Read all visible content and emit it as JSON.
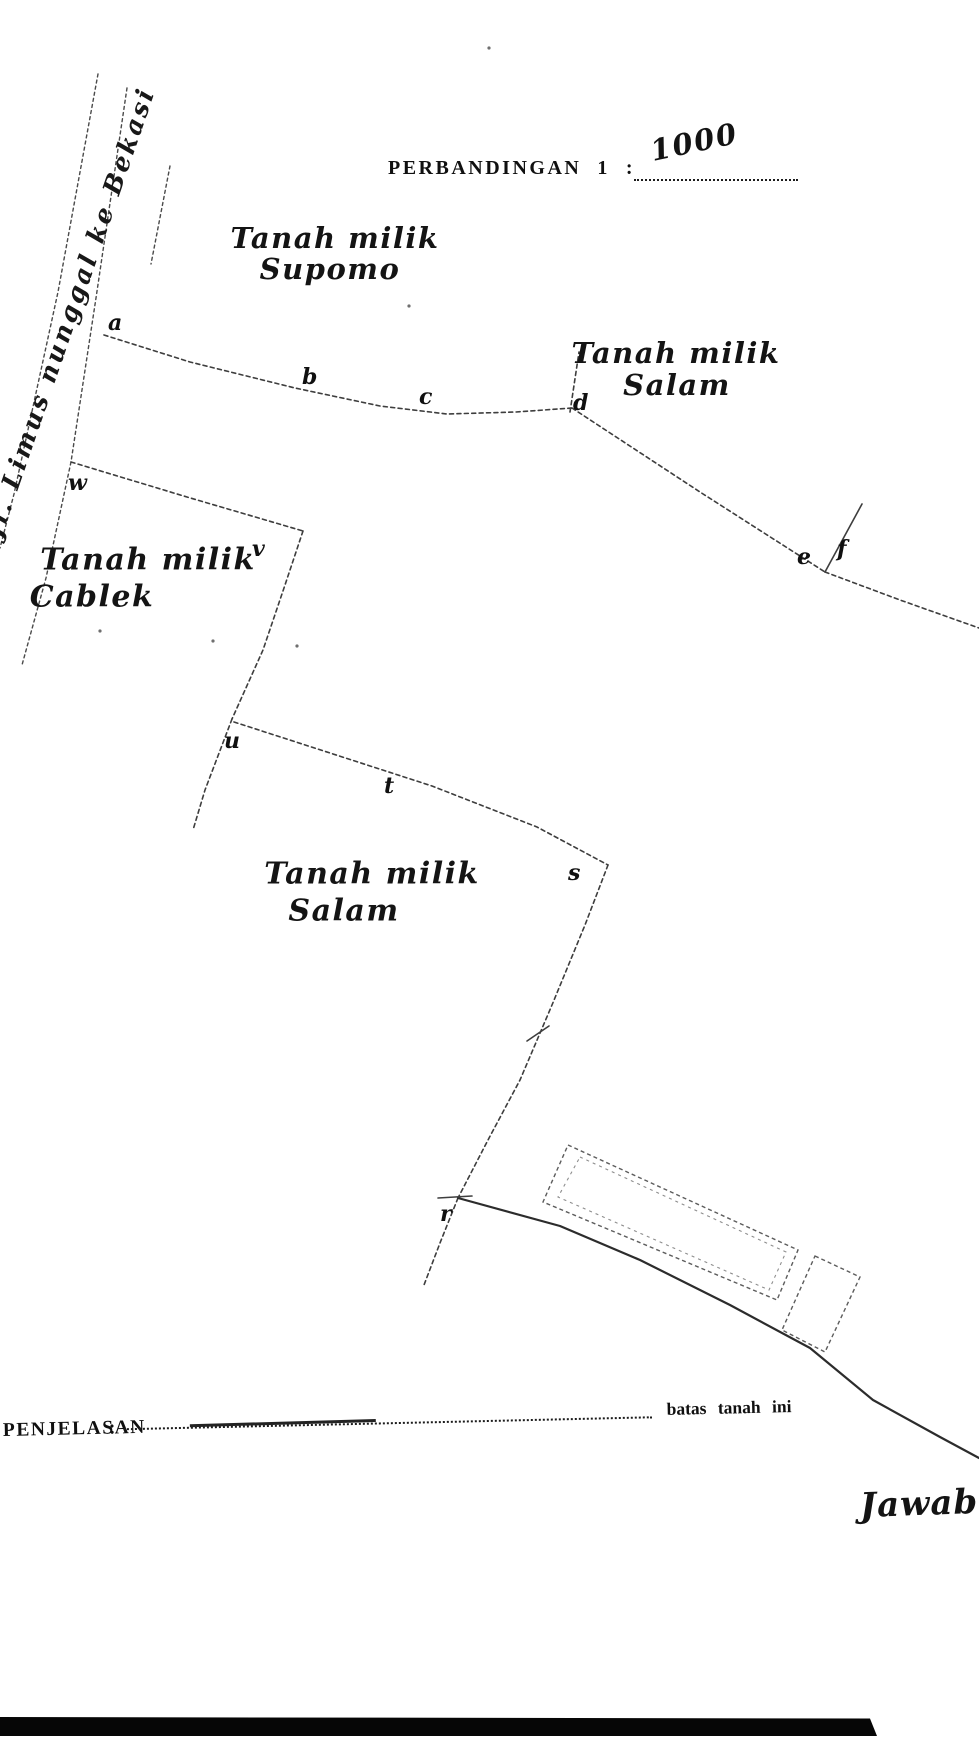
{
  "colors": {
    "paper": "#ffffff",
    "ink": "#1d1d1d",
    "line": "#3e3e3e",
    "scan_bar": "#060606"
  },
  "header": {
    "scale_label": "PERBANDINGAN",
    "scale_number": "1",
    "scale_colon": ":",
    "scale_value_handwritten": "1000"
  },
  "road": {
    "label": "Jl. Limus nunggal ke Bekasi"
  },
  "parcels": [
    {
      "id": "supomo",
      "line1": "Tanah milik",
      "line2": "Supomo",
      "x1": 335,
      "y1": 238,
      "x2": 330,
      "y2": 269,
      "size": 29,
      "rot": -2
    },
    {
      "id": "salam-top",
      "line1": "Tanah milik",
      "line2": "Salam",
      "x1": 676,
      "y1": 353,
      "x2": 677,
      "y2": 385,
      "size": 29,
      "rot": -2
    },
    {
      "id": "cablek",
      "line1": "Tanah milik",
      "line2": "Cablek",
      "x1": 148,
      "y1": 560,
      "x2": 92,
      "y2": 597,
      "size": 30,
      "rot": -4
    },
    {
      "id": "salam-bottom",
      "line1": "Tanah milik",
      "line2": "Salam",
      "x1": 372,
      "y1": 874,
      "x2": 344,
      "y2": 911,
      "size": 30,
      "rot": -4
    }
  ],
  "map": {
    "survey_points": [
      {
        "label": "a",
        "x": 108,
        "y": 312
      },
      {
        "label": "b",
        "x": 302,
        "y": 366
      },
      {
        "label": "c",
        "x": 419,
        "y": 386
      },
      {
        "label": "d",
        "x": 573,
        "y": 392
      },
      {
        "label": "e",
        "x": 797,
        "y": 546
      },
      {
        "label": "f",
        "x": 837,
        "y": 538
      },
      {
        "label": "w",
        "x": 68,
        "y": 472
      },
      {
        "label": "v",
        "x": 252,
        "y": 538
      },
      {
        "label": "u",
        "x": 224,
        "y": 730
      },
      {
        "label": "t",
        "x": 384,
        "y": 775
      },
      {
        "label": "s",
        "x": 568,
        "y": 862
      },
      {
        "label": "r",
        "x": 440,
        "y": 1203
      }
    ],
    "lines": [
      {
        "name": "road-edge-left",
        "style": "road",
        "points": [
          [
            98,
            74
          ],
          [
            58,
            292
          ],
          [
            14,
            494
          ],
          [
            0,
            548
          ]
        ]
      },
      {
        "name": "road-edge-main",
        "style": "road",
        "points": [
          [
            127,
            88
          ],
          [
            96,
            298
          ],
          [
            71,
            462
          ],
          [
            46,
            578
          ],
          [
            22,
            665
          ]
        ]
      },
      {
        "name": "road-edge-fragment",
        "style": "road",
        "points": [
          [
            170,
            166
          ],
          [
            151,
            264
          ]
        ]
      },
      {
        "name": "boundary-a-d",
        "style": "dashed",
        "points": [
          [
            104,
            335
          ],
          [
            190,
            362
          ],
          [
            295,
            388
          ],
          [
            380,
            406
          ],
          [
            447,
            414
          ],
          [
            516,
            412
          ],
          [
            572,
            408
          ]
        ]
      },
      {
        "name": "spur-above-d",
        "style": "dashed",
        "points": [
          [
            570,
            412
          ],
          [
            579,
            352
          ]
        ]
      },
      {
        "name": "boundary-d-e",
        "style": "dashed",
        "points": [
          [
            572,
            408
          ],
          [
            700,
            492
          ],
          [
            825,
            572
          ]
        ]
      },
      {
        "name": "boundary-e-to-edge",
        "style": "dashed",
        "points": [
          [
            825,
            572
          ],
          [
            900,
            600
          ],
          [
            979,
            628
          ]
        ]
      },
      {
        "name": "spur-e-f",
        "style": "solid",
        "points": [
          [
            825,
            572
          ],
          [
            862,
            504
          ]
        ]
      },
      {
        "name": "boundary-w-v",
        "style": "dashed",
        "points": [
          [
            71,
            462
          ],
          [
            187,
            497
          ],
          [
            303,
            531
          ]
        ]
      },
      {
        "name": "boundary-v-u",
        "style": "dashed",
        "points": [
          [
            303,
            531
          ],
          [
            285,
            585
          ],
          [
            263,
            650
          ],
          [
            232,
            719
          ]
        ]
      },
      {
        "name": "boundary-below-u",
        "style": "dashed",
        "points": [
          [
            232,
            719
          ],
          [
            205,
            790
          ],
          [
            193,
            830
          ]
        ]
      },
      {
        "name": "boundary-u-s",
        "style": "dashed",
        "points": [
          [
            234,
            722
          ],
          [
            330,
            753
          ],
          [
            432,
            786
          ],
          [
            537,
            827
          ],
          [
            608,
            865
          ]
        ]
      },
      {
        "name": "boundary-s-r",
        "style": "dashed",
        "points": [
          [
            608,
            865
          ],
          [
            585,
            925
          ],
          [
            552,
            1005
          ],
          [
            520,
            1080
          ],
          [
            488,
            1140
          ],
          [
            458,
            1198
          ]
        ]
      },
      {
        "name": "boundary-below-r",
        "style": "dashed",
        "points": [
          [
            458,
            1198
          ],
          [
            440,
            1243
          ],
          [
            424,
            1285
          ]
        ]
      },
      {
        "name": "boundary-south-solid",
        "style": "solid thick",
        "points": [
          [
            458,
            1198
          ],
          [
            560,
            1226
          ],
          [
            640,
            1260
          ],
          [
            730,
            1305
          ],
          [
            810,
            1348
          ],
          [
            873,
            1400
          ],
          [
            940,
            1437
          ],
          [
            979,
            1458
          ]
        ]
      },
      {
        "name": "tick-on-s-r",
        "style": "solid",
        "points": [
          [
            527,
            1041
          ],
          [
            549,
            1026
          ]
        ]
      },
      {
        "name": "tick-at-r",
        "style": "solid",
        "points": [
          [
            438,
            1198
          ],
          [
            472,
            1196
          ]
        ]
      }
    ],
    "buildings": [
      {
        "name": "building-large-outer",
        "inner": false,
        "points": [
          [
            568,
            1145
          ],
          [
            798,
            1250
          ],
          [
            777,
            1300
          ],
          [
            543,
            1202
          ]
        ]
      },
      {
        "name": "building-large-inner",
        "inner": true,
        "points": [
          [
            580,
            1157
          ],
          [
            786,
            1252
          ],
          [
            769,
            1290
          ],
          [
            558,
            1197
          ]
        ]
      },
      {
        "name": "building-small",
        "inner": false,
        "points": [
          [
            815,
            1256
          ],
          [
            860,
            1277
          ],
          [
            825,
            1352
          ],
          [
            782,
            1330
          ]
        ]
      }
    ],
    "specks": [
      [
        100,
        631
      ],
      [
        213,
        641
      ],
      [
        489,
        48
      ],
      [
        297,
        646
      ],
      [
        409,
        306
      ]
    ]
  },
  "legend": {
    "title": "PENJELASAN",
    "colon": ":",
    "line_label": "batas tanah ini"
  },
  "footer": {
    "handwritten_note": "Jawab"
  }
}
